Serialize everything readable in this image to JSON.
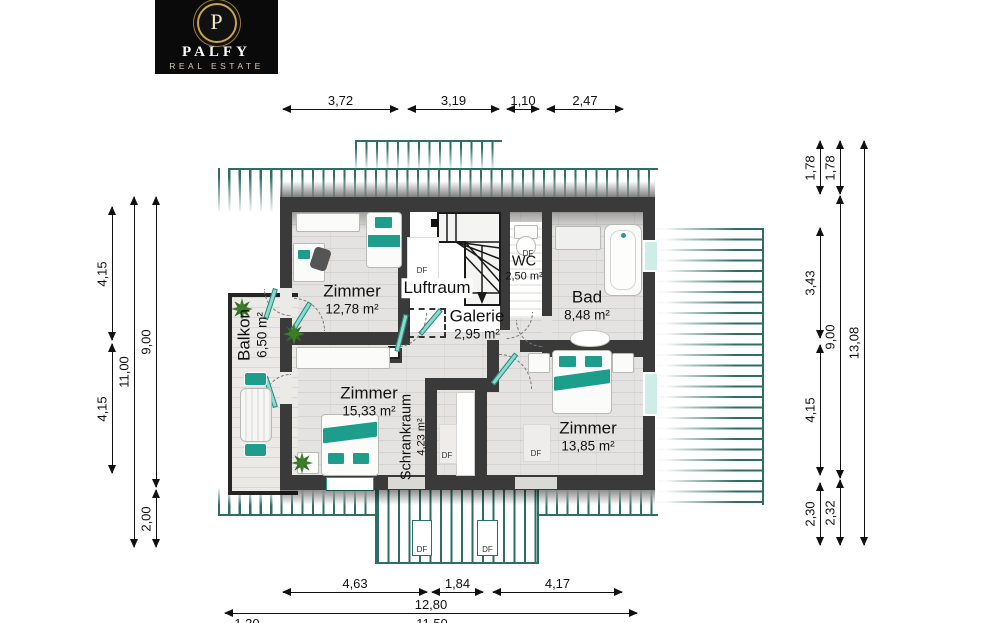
{
  "logo": {
    "monogram": "P",
    "name": "PALFY",
    "subtitle": "REAL ESTATE"
  },
  "rooms": {
    "zimmer1": {
      "name": "Zimmer",
      "area": "12,78 m²"
    },
    "luftraum": {
      "name": "Luftraum"
    },
    "wc": {
      "name": "WC",
      "area": "2,50 m²"
    },
    "bad": {
      "name": "Bad",
      "area": "8,48 m²"
    },
    "galerie": {
      "name": "Galerie",
      "area": "2,95 m²"
    },
    "balkon": {
      "name": "Balkon",
      "area": "6,50 m²"
    },
    "zimmer2": {
      "name": "Zimmer",
      "area": "15,33 m²"
    },
    "schrankraum": {
      "name": "Schrankraum",
      "area": "4,23 m²"
    },
    "zimmer3": {
      "name": "Zimmer",
      "area": "13,85 m²"
    }
  },
  "labels": {
    "df": "DF"
  },
  "dimensions": {
    "top": [
      "3,72",
      "3,19",
      "1,10",
      "2,47"
    ],
    "left": {
      "col1": [
        "4,15",
        "4,15"
      ],
      "col2": [
        "11,00"
      ],
      "col3": [
        "9,00",
        "2,00"
      ]
    },
    "right": {
      "col1": [
        "1,78",
        "3,43",
        "4,15",
        "2,30"
      ],
      "col2": [
        "1,78",
        "9,00",
        "2,32"
      ],
      "col3": [
        "13,08"
      ]
    },
    "bottom": {
      "row1": [
        "4,63",
        "1,84",
        "4,17"
      ],
      "row2": [
        "12,80"
      ],
      "row3": [
        "1,30",
        "11,50"
      ]
    }
  },
  "colors": {
    "accent": "#1d9e8c",
    "hatch_line": "#2e6f63",
    "wall": "#3a3a3a",
    "plant": "#3d7d2a",
    "logo_gold": "#c9a54e"
  }
}
